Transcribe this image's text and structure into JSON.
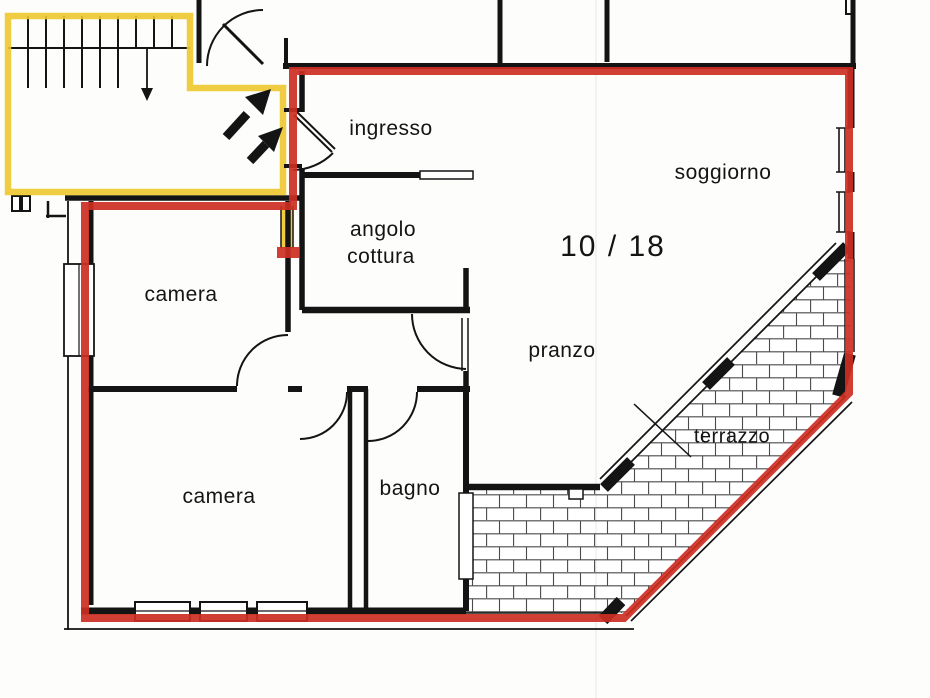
{
  "document": {
    "type": "apartment floor plan (scanned)",
    "sheet_number": "10 / 18"
  },
  "rooms": {
    "ingresso": "ingresso",
    "soggiorno": "soggiorno",
    "angolo_cottura_line1": "angolo",
    "angolo_cottura_line2": "cottura",
    "camera_1": "camera",
    "pranzo": "pranzo",
    "terrazzo": "terrazzo",
    "camera_2": "camera",
    "bagno": "bagno"
  },
  "colors": {
    "apartment_boundary_red": "#cd2f23",
    "common_area_yellow": "#edc72e",
    "wall_black": "#141414",
    "brick_line": "#4a4a4a",
    "paper_white": "#fdfdfc"
  },
  "icons": {
    "entry_direction_arrows": "two bold arrows pointing up-right at apartment entrance",
    "stairs_down_arrow": "down arrow on stairwell walking line"
  }
}
